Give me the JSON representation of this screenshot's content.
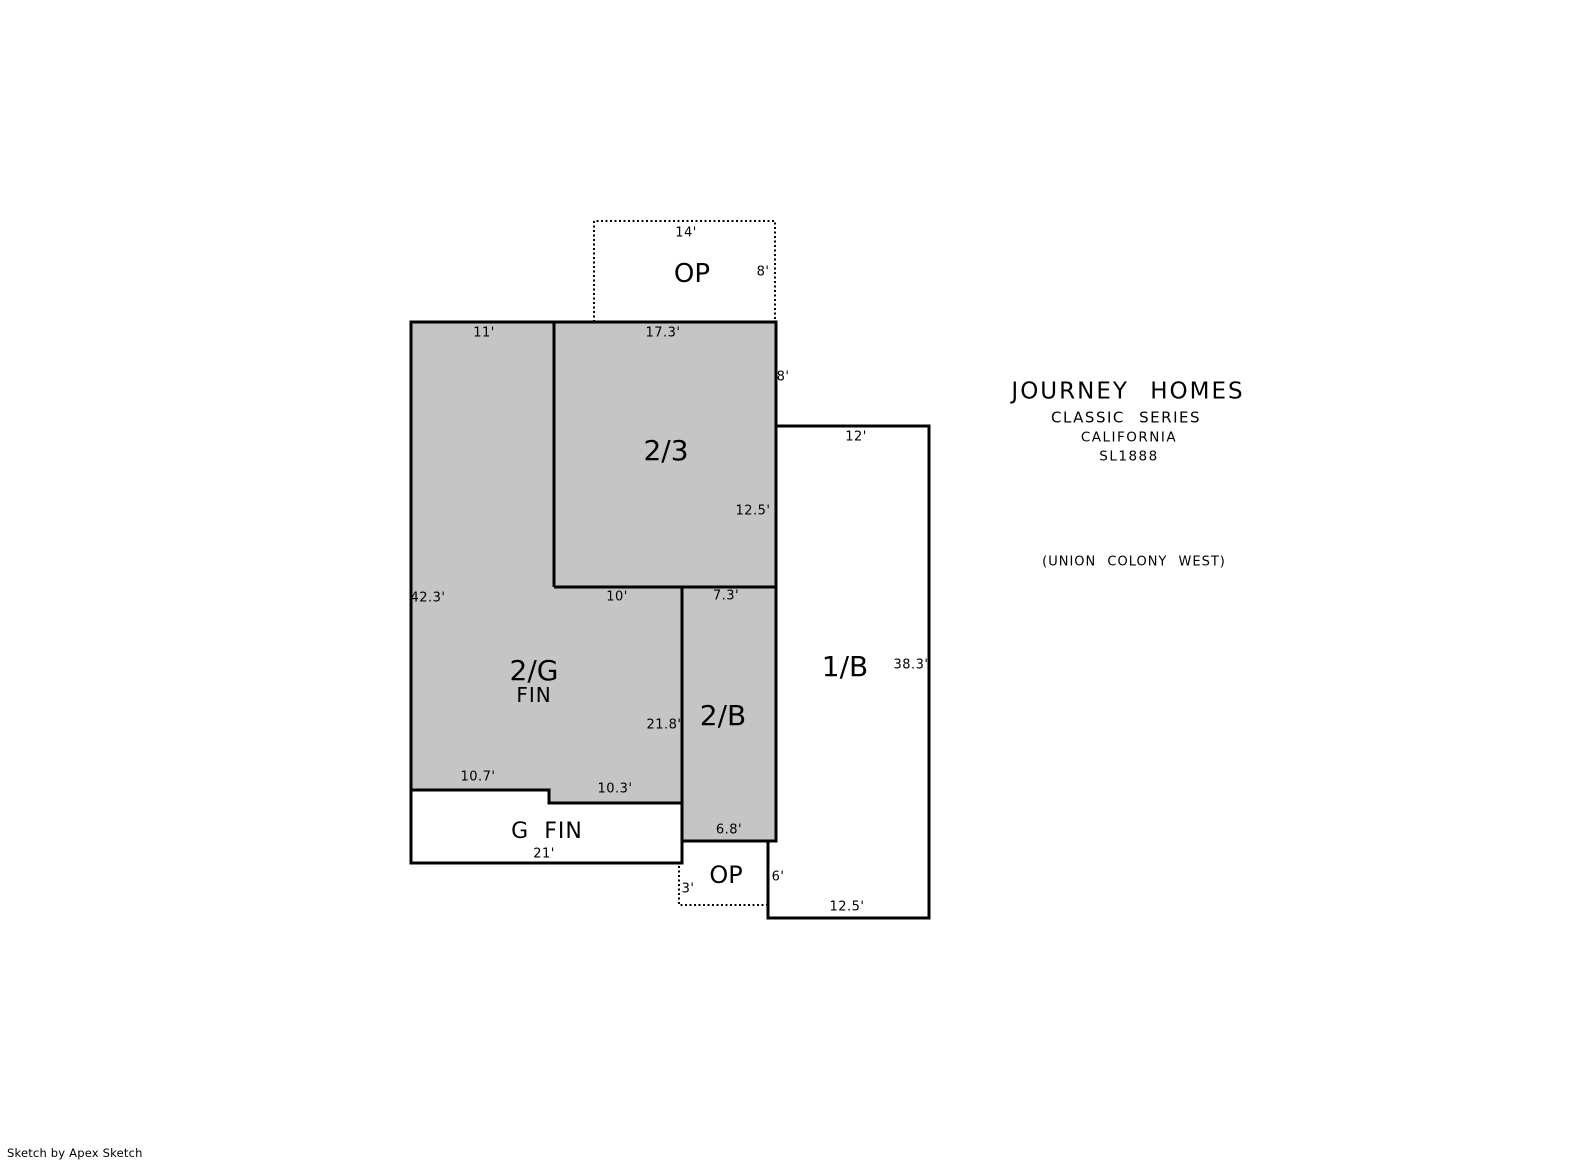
{
  "colors": {
    "background": "#ffffff",
    "area_fill": "#c5c5c5",
    "line": "#000000",
    "text": "#000000"
  },
  "labels": {
    "op_top": "OP",
    "op_bottom": "OP",
    "room_23": "2/3",
    "room_2g": "2/G",
    "room_2g_sub": "FIN",
    "room_2b": "2/B",
    "room_1b": "1/B",
    "g_fin": "G FIN"
  },
  "dimensions": {
    "op_top_width": "14'",
    "op_top_height": "8'",
    "top_left_width": "11'",
    "room_23_width": "17.3'",
    "room_23_upper_right": "8'",
    "room_23_lower_right": "12.5'",
    "room_1b_top": "12'",
    "left_height": "42.3'",
    "room_2g_top": "10'",
    "room_2b_top": "7.3'",
    "room_2g_right": "21.8'",
    "room_1b_right": "38.3'",
    "gfin_step_left": "10.7'",
    "gfin_step_right": "10.3'",
    "gfin_bottom": "21'",
    "room_2b_bottom": "6.8'",
    "op_bottom_left": "3'",
    "room_1b_lower_left": "6'",
    "room_1b_bottom": "12.5'"
  },
  "title_block": {
    "company": "JOURNEY HOMES",
    "series": "CLASSIC SERIES",
    "model_line": "CALIFORNIA",
    "model_number": "SL1888",
    "subdivision": "(UNION COLONY WEST)"
  },
  "watermark": "Sketch by Apex Sketch"
}
